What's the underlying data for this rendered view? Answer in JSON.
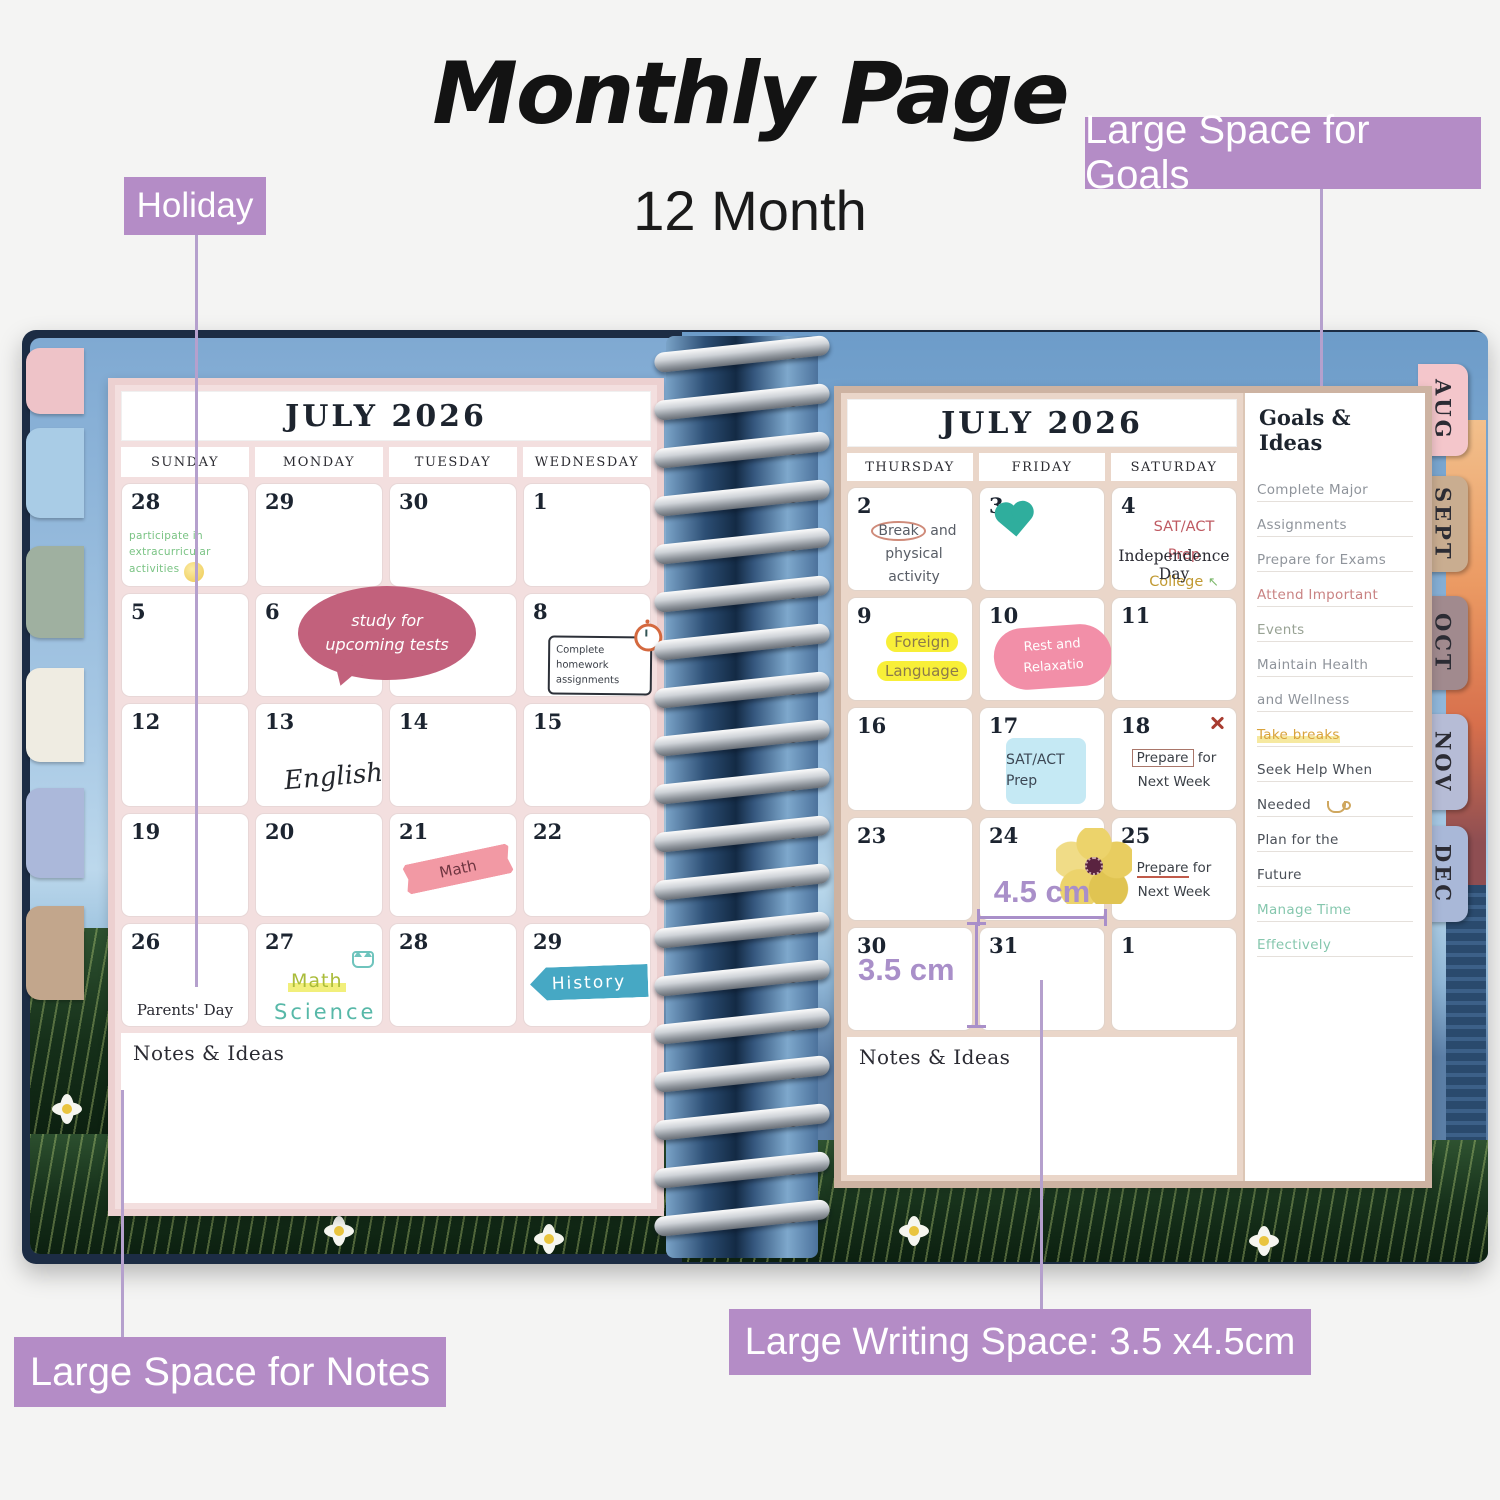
{
  "title": {
    "main": "Monthly Page",
    "subtitle": "12 Month"
  },
  "callouts": {
    "holiday": "Holiday",
    "goals": "Large Space for Goals",
    "notes": "Large Space for Notes",
    "writing_space": "Large Writing Space: 3.5 x4.5cm"
  },
  "left_page": {
    "month_title": "JULY 2026",
    "day_headers": [
      "SUNDAY",
      "MONDAY",
      "TUESDAY",
      "WEDNESDAY"
    ],
    "dates": [
      "28",
      "29",
      "30",
      "1",
      "5",
      "6",
      "",
      "8",
      "12",
      "13",
      "14",
      "15",
      "19",
      "20",
      "21",
      "22",
      "26",
      "27",
      "28",
      "29"
    ],
    "notes": {
      "extracurricular": "participate in extracurricular activities",
      "study_bubble": "study for upcoming tests",
      "homework": "Complete homework assignments",
      "english": "English",
      "math_tape": "Math",
      "parents_day": "Parents' Day",
      "math": "Math",
      "science": "Science",
      "history": "History"
    },
    "notes_label": "Notes & Ideas"
  },
  "right_page": {
    "month_title": "JULY 2026",
    "day_headers": [
      "THURSDAY",
      "FRIDAY",
      "SATURDAY"
    ],
    "dates": [
      "2",
      "3",
      "4",
      "9",
      "10",
      "11",
      "16",
      "17",
      "18",
      "23",
      "24",
      "25",
      "30",
      "31",
      "1"
    ],
    "notes": {
      "break_word": "Break",
      "break_rest": "and physical activity",
      "sat_prep": "SAT/ACT Prep",
      "college": "College",
      "or_word": "or",
      "research": "Research",
      "arrow_up": "↖",
      "arrow_down": "↓",
      "independence": "Independence Day",
      "foreign_language": "Foreign Language",
      "rest": "Rest and Relaxatio",
      "sat_sticky": "SAT/ACT Prep",
      "prepare": "Prepare",
      "for_word": "for",
      "next_week": "Next Week"
    },
    "measurements": {
      "width": "4.5 cm",
      "height": "3.5 cm"
    },
    "notes_label": "Notes & Ideas"
  },
  "goals_panel": {
    "header": "Goals & Ideas",
    "items": [
      {
        "text": "Complete Major",
        "color": "#8f949b"
      },
      {
        "text": "Assignments",
        "color": "#8f949b"
      },
      {
        "text": "Prepare for Exams",
        "color": "#8f949b"
      },
      {
        "text": "Attend Important",
        "color": "#c98383"
      },
      {
        "text": "Events",
        "color": "#98a294"
      },
      {
        "text": "Maintain Health",
        "color": "#8f949b"
      },
      {
        "text": "and Wellness",
        "color": "#8f949b"
      },
      {
        "text": "Take breaks",
        "color": "#d9a33c"
      },
      {
        "text": "Seek Help When",
        "color": "#4a4f57"
      },
      {
        "text": "Needed",
        "color": "#4a4f57"
      },
      {
        "text": "Plan for the",
        "color": "#4a4f57"
      },
      {
        "text": "Future",
        "color": "#4a4f57"
      },
      {
        "text": "Manage Time",
        "color": "#86c7ae"
      },
      {
        "text": "Effectively",
        "color": "#86c7ae"
      }
    ]
  },
  "tabs": [
    "AUG",
    "SEPT",
    "OCT",
    "NOV",
    "DEC"
  ],
  "colors": {
    "callout_purple": "#b48cc6",
    "measure_purple": "#a98fc9",
    "bubble_pink": "#c2617c",
    "washi_pink": "#f08794",
    "highlight_yellow": "#f8ef38",
    "sticky_blue": "#c5e9f4",
    "history_teal": "#46a8c4",
    "heart_teal": "#2fae9d",
    "flower_yellow": "#ecd36b",
    "left_frame_pink": "#ecd0d0",
    "right_frame_tan": "#cdb3a2",
    "tab_colors": [
      "#f4c6cb",
      "#c9ad90",
      "#a18a8e",
      "#b6bcd6",
      "#a9b8d8"
    ]
  }
}
